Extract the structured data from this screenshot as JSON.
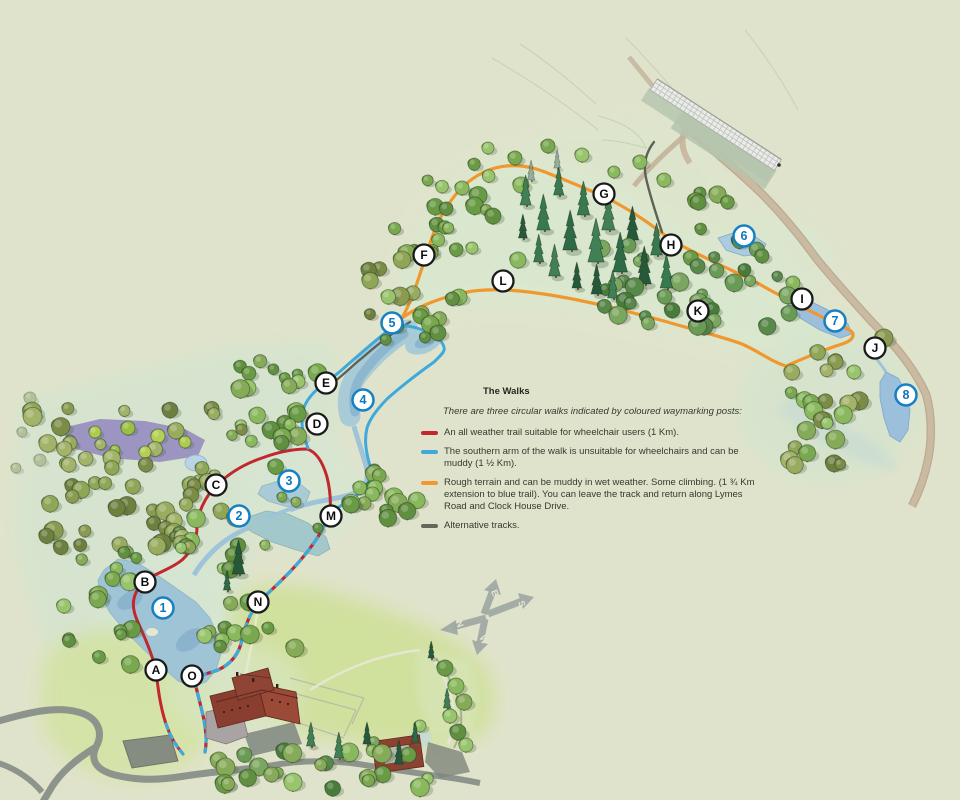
{
  "legend": {
    "title": "The Walks",
    "intro": "There are three circular walks indicated by coloured waymarking posts:",
    "items": [
      {
        "id": "red-trail",
        "color": "#c1272d",
        "text": "An all weather trail suitable for wheelchair users (1 Km)."
      },
      {
        "id": "blue-trail",
        "color": "#3fa9dc",
        "text": "The southern arm of the walk is unsuitable for wheelchairs and can be muddy (1 ½ Km)."
      },
      {
        "id": "orange-trail",
        "color": "#f0982e",
        "text": "Rough terrain and can be muddy in wet weather. Some climbing. (1 ¾ Km extension to blue trail). You can leave the track and return along Lymes Road and Clock House Drive."
      },
      {
        "id": "alternative-tracks",
        "color": "#63685d",
        "text": "Alternative tracks."
      }
    ]
  },
  "markers": {
    "letter_style": {
      "fill": "#ffffff",
      "ring": "#1a1a1a",
      "text": "#0d0d0d"
    },
    "number_style": {
      "fill": "#ffffff",
      "ring": "#1580c4",
      "text": "#0f76bb"
    },
    "letters": [
      {
        "label": "A",
        "x": 156,
        "y": 670
      },
      {
        "label": "B",
        "x": 145,
        "y": 582
      },
      {
        "label": "C",
        "x": 216,
        "y": 485
      },
      {
        "label": "D",
        "x": 317,
        "y": 424
      },
      {
        "label": "E",
        "x": 326,
        "y": 383
      },
      {
        "label": "F",
        "x": 424,
        "y": 255
      },
      {
        "label": "G",
        "x": 604,
        "y": 194
      },
      {
        "label": "H",
        "x": 671,
        "y": 245
      },
      {
        "label": "I",
        "x": 802,
        "y": 299
      },
      {
        "label": "J",
        "x": 875,
        "y": 348
      },
      {
        "label": "K",
        "x": 698,
        "y": 311
      },
      {
        "label": "L",
        "x": 503,
        "y": 281
      },
      {
        "label": "M",
        "x": 331,
        "y": 516
      },
      {
        "label": "N",
        "x": 258,
        "y": 602
      },
      {
        "label": "O",
        "x": 192,
        "y": 676
      }
    ],
    "numbers": [
      {
        "label": "1",
        "x": 163,
        "y": 608
      },
      {
        "label": "2",
        "x": 239,
        "y": 516
      },
      {
        "label": "3",
        "x": 289,
        "y": 481
      },
      {
        "label": "4",
        "x": 363,
        "y": 400
      },
      {
        "label": "5",
        "x": 392,
        "y": 323
      },
      {
        "label": "6",
        "x": 744,
        "y": 236
      },
      {
        "label": "7",
        "x": 835,
        "y": 321
      },
      {
        "label": "8",
        "x": 906,
        "y": 395
      }
    ]
  },
  "compass": {
    "north": "N",
    "east": "E",
    "south": "S",
    "west": "W"
  },
  "colors": {
    "background": "#e0e3cb",
    "meadow": "#d9e8cf",
    "water": "#a9cbd8",
    "water_deep": "#86b2cc",
    "orange_trail": "#f0982e",
    "red_trail": "#c1272d",
    "blue_trail": "#3fa9dc",
    "gray_track": "#5d6257",
    "road": "#8d948b",
    "track_brown": "#c9b89f"
  }
}
